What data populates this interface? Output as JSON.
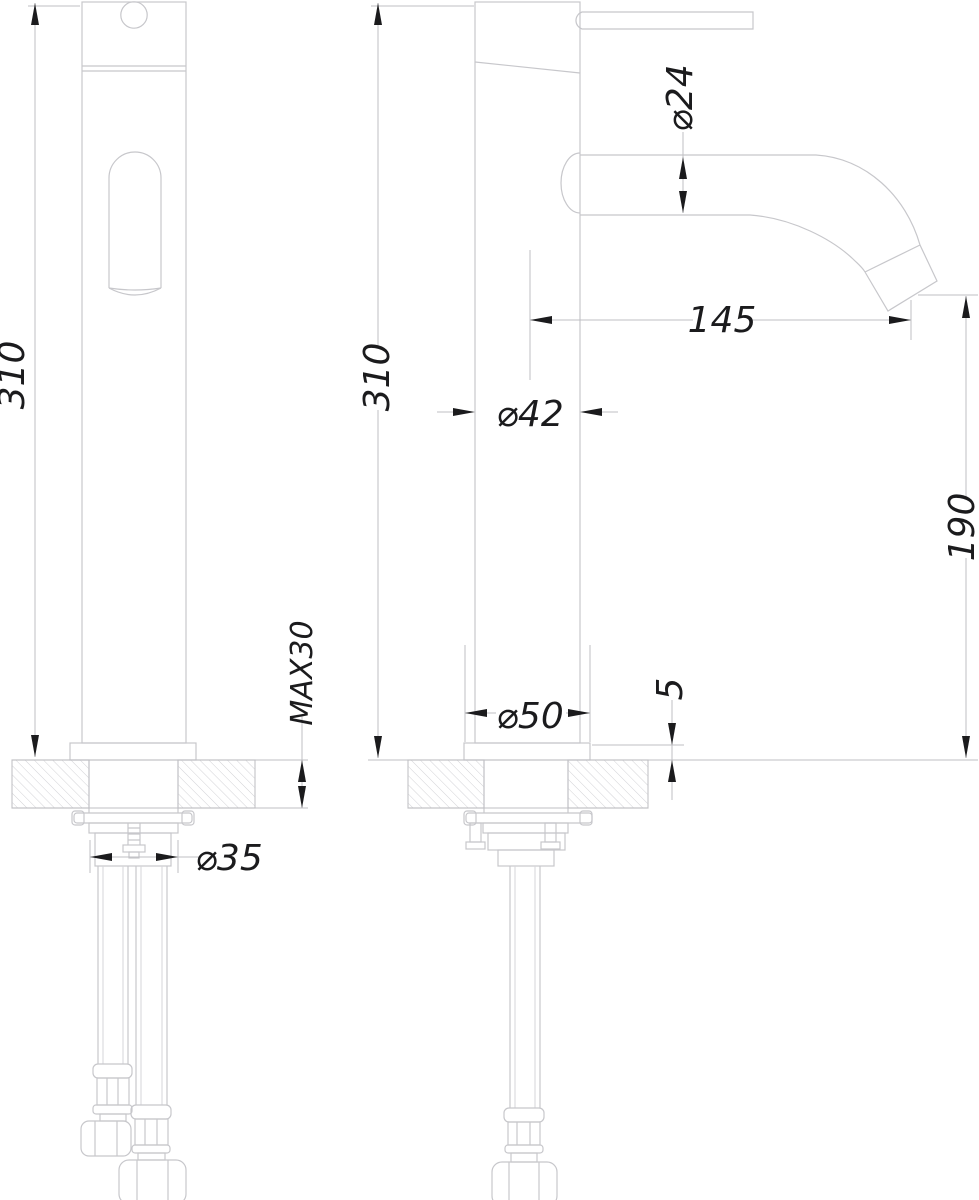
{
  "drawing": {
    "background": "#ffffff",
    "line_colors": {
      "object_line": "#c7c7cb",
      "hidden_detail_line": "#d6d6da",
      "dimension_line": "#bfbfc3",
      "hatch_line": "#d2d2d6",
      "annotation": "#1b1b1d"
    },
    "views": [
      {
        "id": "front",
        "dimensions": {
          "height": "310",
          "max_counter_thickness": "MAX30",
          "shank_diameter": "⌀35"
        }
      },
      {
        "id": "side",
        "dimensions": {
          "height": "310",
          "spout_tube_diameter": "⌀24",
          "spout_reach": "145",
          "body_diameter": "⌀42",
          "outlet_height": "190",
          "base_diameter": "⌀50",
          "base_plate_height": "5"
        }
      }
    ]
  }
}
